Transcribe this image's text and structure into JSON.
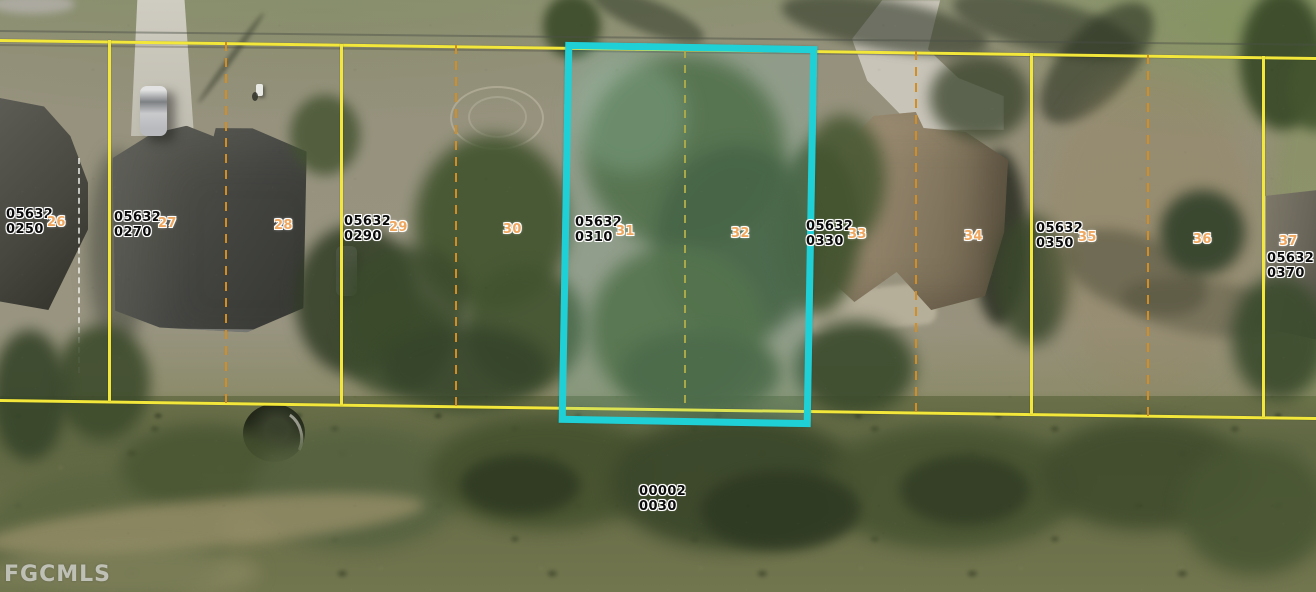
{
  "map": {
    "watermark": "FGCMLS",
    "colors": {
      "highlight_outline": "#1fd0d6",
      "parcel_boundary_line": "#f2e73a",
      "lot_split_line": "#d28e25"
    },
    "parcel_labels": [
      {
        "line1": "05632",
        "line2": "0250"
      },
      {
        "line1": "05632",
        "line2": "0270"
      },
      {
        "line1": "05632",
        "line2": "0290"
      },
      {
        "line1": "05632",
        "line2": "0310",
        "highlighted": true
      },
      {
        "line1": "05632",
        "line2": "0330"
      },
      {
        "line1": "05632",
        "line2": "0350"
      },
      {
        "line1": "05632",
        "line2": "0370"
      }
    ],
    "rear_parcel_label": {
      "line1": "00002",
      "line2": "0030"
    },
    "lot_numbers": [
      {
        "n": "26"
      },
      {
        "n": "27"
      },
      {
        "n": "28"
      },
      {
        "n": "29"
      },
      {
        "n": "30"
      },
      {
        "n": "31"
      },
      {
        "n": "32"
      },
      {
        "n": "33"
      },
      {
        "n": "34"
      },
      {
        "n": "35"
      },
      {
        "n": "36"
      },
      {
        "n": "37"
      }
    ]
  }
}
